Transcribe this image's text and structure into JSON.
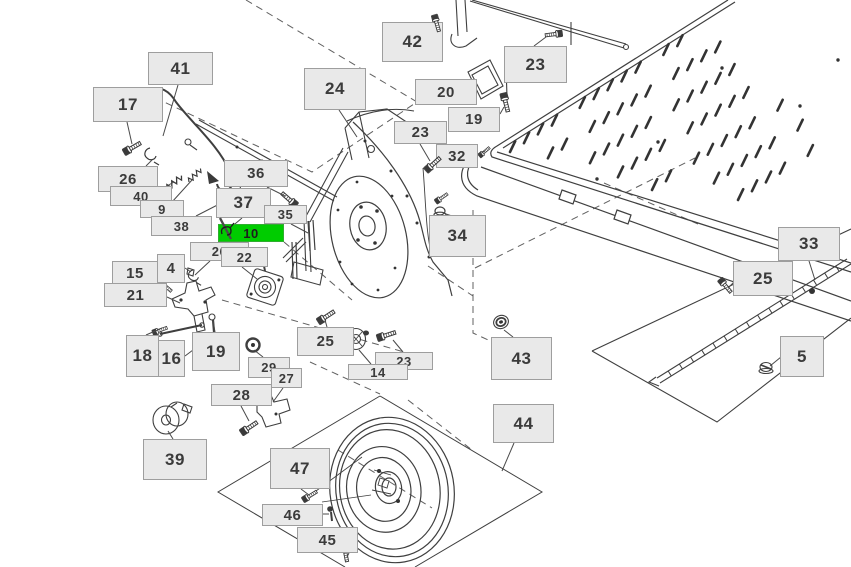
{
  "diagram": {
    "type": "exploded-parts-diagram",
    "background": "#ffffff",
    "line_color": "#3a3a3a",
    "label_style": {
      "bg": "#e9e9e9",
      "border": "#9e9e9e",
      "text_color": "#3b3b3b"
    },
    "highlight_style": {
      "bg": "#00cc00",
      "border": "#2fae2f",
      "text_color": "#1e1e1e"
    },
    "highlight_icon": "clip-pin-icon",
    "selected_part": "10",
    "callouts": [
      {
        "id": "41",
        "text": "41",
        "x": 148,
        "y": 52,
        "w": 65,
        "h": 33,
        "leader": [
          178,
          85,
          163,
          136
        ],
        "highlighted": false
      },
      {
        "id": "17",
        "text": "17",
        "x": 93,
        "y": 87,
        "w": 70,
        "h": 35,
        "leader": [
          127,
          122,
          132,
          144
        ],
        "highlighted": false
      },
      {
        "id": "26a",
        "text": "26",
        "x": 98,
        "y": 166,
        "w": 60,
        "h": 26,
        "leader": [
          146,
          166,
          152,
          160
        ],
        "highlighted": false
      },
      {
        "id": "40",
        "text": "40",
        "x": 110,
        "y": 186,
        "w": 62,
        "h": 20,
        "leader": [
          158,
          191,
          174,
          182
        ],
        "highlighted": false
      },
      {
        "id": "9",
        "text": "9",
        "x": 140,
        "y": 200,
        "w": 44,
        "h": 18,
        "leader": [
          172,
          202,
          192,
          180
        ],
        "highlighted": false
      },
      {
        "id": "38",
        "text": "38",
        "x": 151,
        "y": 216,
        "w": 61,
        "h": 20,
        "leader": [
          196,
          216,
          233,
          197
        ],
        "highlighted": false
      },
      {
        "id": "36",
        "text": "36",
        "x": 224,
        "y": 160,
        "w": 64,
        "h": 27,
        "leader": [
          267,
          187,
          285,
          196
        ],
        "highlighted": false
      },
      {
        "id": "37",
        "text": "37",
        "x": 216,
        "y": 188,
        "w": 55,
        "h": 30,
        "leader": [
          242,
          218,
          229,
          229
        ],
        "highlighted": false
      },
      {
        "id": "35",
        "text": "35",
        "x": 264,
        "y": 205,
        "w": 43,
        "h": 19,
        "leader": [
          291,
          224,
          308,
          233
        ],
        "highlighted": false
      },
      {
        "id": "10",
        "text": "10",
        "x": 218,
        "y": 224,
        "w": 66,
        "h": 18,
        "leader": null,
        "highlighted": true
      },
      {
        "id": "26b",
        "text": "26",
        "x": 190,
        "y": 242,
        "w": 59,
        "h": 19,
        "leader": [
          210,
          261,
          195,
          275
        ],
        "highlighted": false
      },
      {
        "id": "22",
        "text": "22",
        "x": 221,
        "y": 247,
        "w": 47,
        "h": 20,
        "leader": [
          242,
          267,
          257,
          279
        ],
        "highlighted": false
      },
      {
        "id": "4",
        "text": "4",
        "x": 157,
        "y": 254,
        "w": 28,
        "h": 29,
        "leader": [
          185,
          268,
          191,
          272
        ],
        "highlighted": false
      },
      {
        "id": "15",
        "text": "15",
        "x": 112,
        "y": 261,
        "w": 46,
        "h": 25,
        "leader": [
          155,
          283,
          164,
          287
        ],
        "highlighted": false
      },
      {
        "id": "21",
        "text": "21",
        "x": 104,
        "y": 283,
        "w": 63,
        "h": 24,
        "leader": [
          167,
          297,
          180,
          303
        ],
        "highlighted": false
      },
      {
        "id": "18",
        "text": "18",
        "x": 126,
        "y": 335,
        "w": 33,
        "h": 42,
        "leader": [
          146,
          335,
          162,
          328
        ],
        "highlighted": false
      },
      {
        "id": "16",
        "text": "16",
        "x": 158,
        "y": 340,
        "w": 27,
        "h": 37,
        "leader": [
          185,
          356,
          197,
          347
        ],
        "highlighted": false
      },
      {
        "id": "19a",
        "text": "19",
        "x": 192,
        "y": 332,
        "w": 48,
        "h": 39,
        "leader": [
          215,
          332,
          213,
          321
        ],
        "highlighted": false
      },
      {
        "id": "29",
        "text": "29",
        "x": 248,
        "y": 357,
        "w": 42,
        "h": 21,
        "leader": [
          263,
          357,
          254,
          350
        ],
        "highlighted": false
      },
      {
        "id": "27",
        "text": "27",
        "x": 271,
        "y": 368,
        "w": 31,
        "h": 20,
        "leader": [
          283,
          388,
          273,
          402
        ],
        "highlighted": false
      },
      {
        "id": "28",
        "text": "28",
        "x": 211,
        "y": 384,
        "w": 61,
        "h": 22,
        "leader": [
          241,
          406,
          249,
          421
        ],
        "highlighted": false
      },
      {
        "id": "39",
        "text": "39",
        "x": 143,
        "y": 439,
        "w": 64,
        "h": 41,
        "leader": [
          173,
          439,
          168,
          431
        ],
        "highlighted": false
      },
      {
        "id": "24",
        "text": "24",
        "x": 304,
        "y": 68,
        "w": 62,
        "h": 42,
        "leader": [
          339,
          110,
          357,
          137
        ],
        "highlighted": false
      },
      {
        "id": "42",
        "text": "42",
        "x": 382,
        "y": 22,
        "w": 61,
        "h": 40,
        "leader": [
          420,
          37,
          434,
          27
        ],
        "highlighted": false
      },
      {
        "id": "23a",
        "text": "23",
        "x": 504,
        "y": 46,
        "w": 63,
        "h": 37,
        "leader": [
          534,
          46,
          546,
          37
        ],
        "highlighted": false
      },
      {
        "id": "20",
        "text": "20",
        "x": 415,
        "y": 79,
        "w": 62,
        "h": 26,
        "leader": [
          462,
          91,
          471,
          84
        ],
        "highlighted": false
      },
      {
        "id": "19b",
        "text": "19",
        "x": 448,
        "y": 107,
        "w": 52,
        "h": 25,
        "leader": [
          500,
          114,
          504,
          107
        ],
        "highlighted": false
      },
      {
        "id": "23b",
        "text": "23",
        "x": 394,
        "y": 121,
        "w": 53,
        "h": 23,
        "leader": [
          420,
          144,
          430,
          161
        ],
        "highlighted": false
      },
      {
        "id": "32",
        "text": "32",
        "x": 436,
        "y": 144,
        "w": 42,
        "h": 24,
        "leader": [
          478,
          155,
          485,
          151
        ],
        "highlighted": false
      },
      {
        "id": "34",
        "text": "34",
        "x": 429,
        "y": 215,
        "w": 57,
        "h": 42,
        "leader": [
          452,
          216,
          443,
          213
        ],
        "highlighted": false
      },
      {
        "id": "25a",
        "text": "25",
        "x": 297,
        "y": 327,
        "w": 57,
        "h": 29,
        "leader": [
          327,
          327,
          325,
          320
        ],
        "highlighted": false
      },
      {
        "id": "23c",
        "text": "23",
        "x": 375,
        "y": 352,
        "w": 58,
        "h": 18,
        "leader": [
          403,
          352,
          393,
          340
        ],
        "highlighted": false
      },
      {
        "id": "14",
        "text": "14",
        "x": 348,
        "y": 364,
        "w": 60,
        "h": 16,
        "leader": [
          371,
          364,
          359,
          350
        ],
        "highlighted": false
      },
      {
        "id": "43",
        "text": "43",
        "x": 491,
        "y": 337,
        "w": 61,
        "h": 43,
        "leader": [
          513,
          337,
          504,
          330
        ],
        "highlighted": false
      },
      {
        "id": "33",
        "text": "33",
        "x": 778,
        "y": 227,
        "w": 62,
        "h": 34,
        "leader": [
          809,
          261,
          815,
          280
        ],
        "highlighted": false
      },
      {
        "id": "25b",
        "text": "25",
        "x": 733,
        "y": 261,
        "w": 60,
        "h": 35,
        "leader": [
          734,
          282,
          728,
          288
        ],
        "highlighted": false
      },
      {
        "id": "5",
        "text": "5",
        "x": 780,
        "y": 336,
        "w": 44,
        "h": 41,
        "leader": [
          781,
          357,
          770,
          366
        ],
        "highlighted": false
      },
      {
        "id": "44",
        "text": "44",
        "x": 493,
        "y": 404,
        "w": 61,
        "h": 39,
        "leader": [
          514,
          443,
          502,
          471
        ],
        "highlighted": false
      },
      {
        "id": "47",
        "text": "47",
        "x": 270,
        "y": 448,
        "w": 60,
        "h": 41,
        "leader": [
          301,
          489,
          309,
          495
        ],
        "highlighted": false
      },
      {
        "id": "46",
        "text": "46",
        "x": 262,
        "y": 504,
        "w": 61,
        "h": 22,
        "leader": [
          323,
          514,
          329,
          514
        ],
        "highlighted": false
      },
      {
        "id": "45",
        "text": "45",
        "x": 297,
        "y": 527,
        "w": 61,
        "h": 26,
        "leader": [
          349,
          553,
          347,
          557
        ],
        "highlighted": false
      }
    ]
  }
}
